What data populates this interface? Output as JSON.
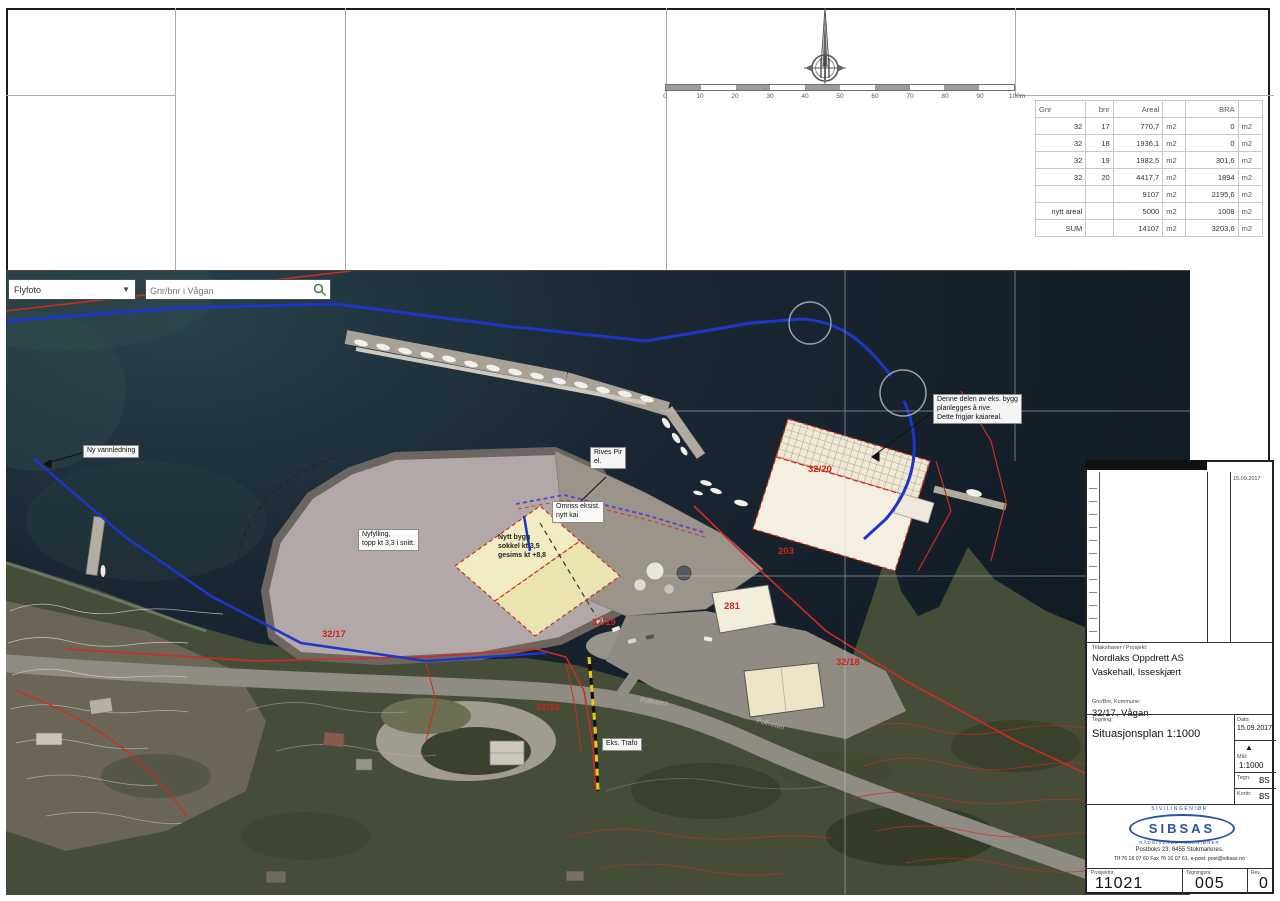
{
  "area_table": {
    "headers": [
      "Gnr",
      "bnr",
      "Areal",
      "",
      "BRA",
      ""
    ],
    "rows": [
      [
        "32",
        "17",
        "770,7",
        "m2",
        "0",
        "m2"
      ],
      [
        "32",
        "18",
        "1936,1",
        "m2",
        "0",
        "m2"
      ],
      [
        "32",
        "19",
        "1982,5",
        "m2",
        "301,6",
        "m2"
      ],
      [
        "32",
        "20",
        "4417,7",
        "m2",
        "1894",
        "m2"
      ],
      [
        "",
        "",
        "9107",
        "m2",
        "2195,6",
        "m2"
      ],
      [
        "nytt areal",
        "",
        "5000",
        "m2",
        "1008",
        "m2"
      ],
      [
        "SUM",
        "",
        "14107",
        "m2",
        "3203,6",
        "m2"
      ]
    ]
  },
  "scalebar": {
    "labels": [
      "0",
      "10",
      "20",
      "30",
      "40",
      "50",
      "60",
      "70",
      "80",
      "90",
      "100m"
    ]
  },
  "map": {
    "layer_dropdown": "Flyfoto",
    "search_placeholder": "Gnr/bnr i Vågan",
    "notes": {
      "pipeline": "Ny vannledning",
      "fill_1": "Nyfylling,",
      "fill_2": "topp kt 3,3 i snitt.",
      "newbuild_1": "Nytt bygg",
      "newbuild_2": "sokkel kt 3,5",
      "newbuild_3": "gesims kt +8,8",
      "pier_1": "Rives Pir",
      "pier_2": "el.",
      "quay_1": "Omriss eksist.",
      "quay_2": "nytt kai",
      "demolish_1": "Denne delen av eks. bygg",
      "demolish_2": "planlegges å rive.",
      "demolish_3": "Dette frigjør kaiareal.",
      "trafo": "Eks. Trafo"
    },
    "parcels": {
      "p3220": "32/20",
      "p203": "203",
      "p281": "281",
      "p3219": "32/19",
      "p3217": "32/17",
      "p3216": "32/16",
      "p3218": "32/18"
    },
    "roads": {
      "r1": "Pollveien",
      "r2": "Pollveien"
    }
  },
  "titleblock": {
    "rev_date": "15.09.2017",
    "client_label": "Tiltakshaver / Prosjekt:",
    "client_1": "Nordlaks Oppdrett AS",
    "client_2": "Vaskehall, Isseskjært",
    "property_label": "Gnr/Bnr, Kommune:",
    "property": "32/17, Vågan",
    "drawing_label": "Tegning:",
    "drawing_title": "Situasjonsplan 1:1000",
    "date_label": "Dato:",
    "date": "15.09.2017",
    "scale_label": "Mål:",
    "scale": "1:1000",
    "drawn_label": "Tegn:",
    "drawn": "BS",
    "checked_label": "Kontr:",
    "checked": "BS",
    "logo_top": "SIVILINGENIØR",
    "logo_name": "SIBSAS",
    "logo_sub": "RÅDGIVENDE INGENIØRER",
    "address": "Postboks 23, 8455 Stokmarknes.",
    "contact": "Tlf 76 16 07 60  Fax 76 16 07 61,  e-post: post@sibsas.no",
    "project_no_label": "Prosjektnr.",
    "project_no": "11021",
    "drawing_no_label": "Tegningsnr.",
    "drawing_no": "005",
    "rev_label": "Rev.",
    "rev": "0"
  },
  "colors": {
    "boundary_red": "#cf2b20",
    "pipeline_blue": "#1d35c8",
    "logo_blue": "#2a52a8",
    "sea_dark": "#141d27"
  }
}
